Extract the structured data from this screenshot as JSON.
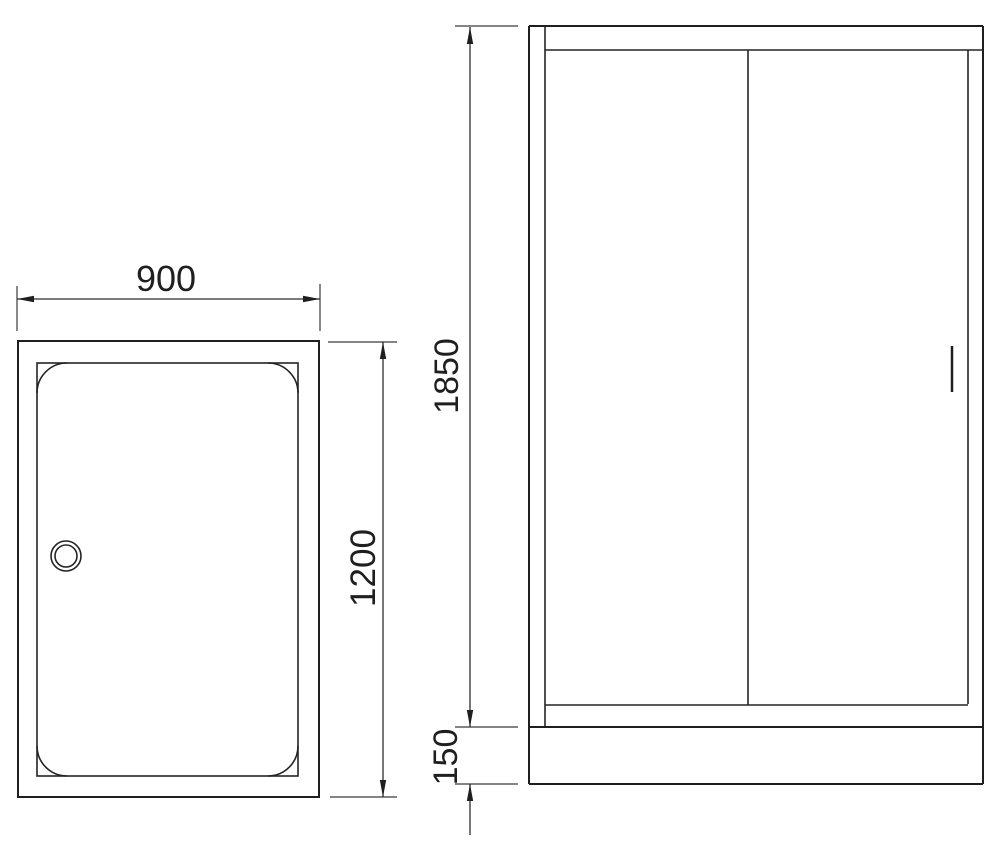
{
  "drawing": {
    "background": "#ffffff",
    "line_color": "#1f1f1f",
    "dimension_color": "#2e2e2e",
    "plan_view": {
      "width_label": "900",
      "depth_label": "1200"
    },
    "elevation_view": {
      "height_label": "1850",
      "base_height_label": "150"
    }
  }
}
